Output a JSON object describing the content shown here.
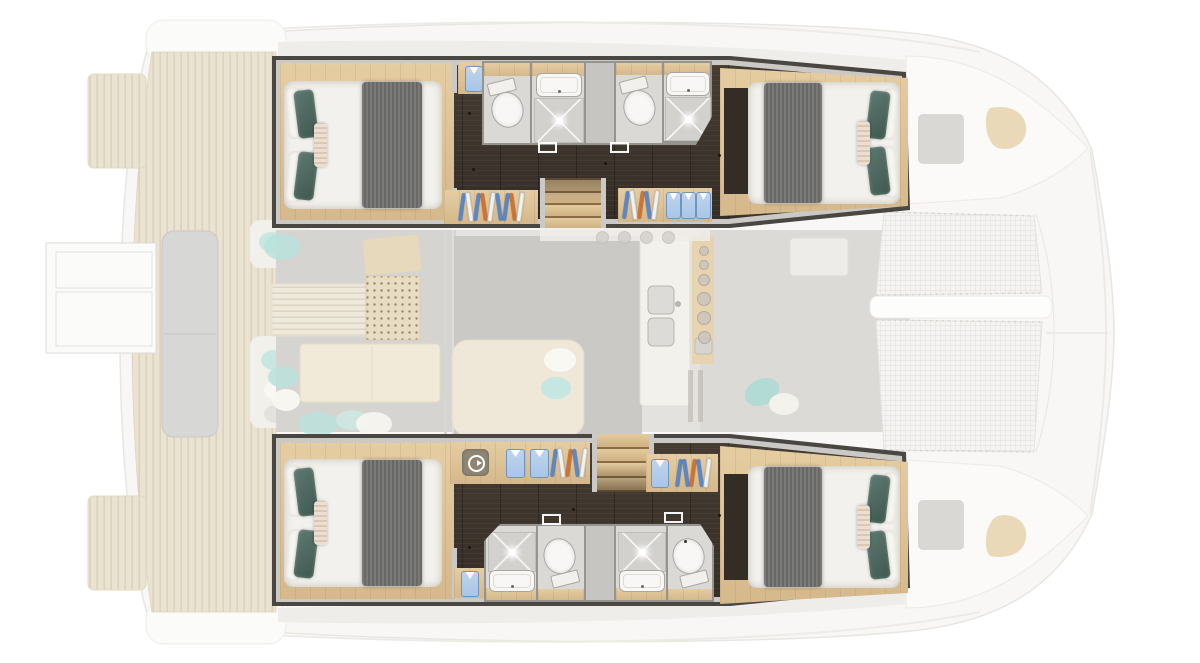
{
  "diagram": {
    "kind": "catamaran-floor-plan",
    "focused_level": "hull accommodation deck (4 cabins, 4 en-suite bathrooms)",
    "faded_level": "main deck (aft cockpit, salon, galley, foredeck trampolines)"
  },
  "colors": {
    "wall_dark": "#4a4742",
    "wall_light": "#cbc9c5",
    "floor_dark": "#342d26",
    "floor_dark_hi": "#473d33",
    "wood": "#d5b88b",
    "wood_hi": "#e5cda2",
    "mattress": "#f3f1ed",
    "pillow_white": "#f7f5f1",
    "teal": "#5d7971",
    "teal_dark": "#40584f",
    "cushion": "#ecdfd2",
    "cushion_line": "#dbc8b4",
    "bath_floor": "#dad9d6",
    "bath_wall": "#96948f",
    "partition": "#c7c5c1",
    "fixture": "#f8f7f5",
    "fixture_line": "#a9a7a2",
    "hanger_blue": "#5b87c5",
    "hanger_orange": "#cc7434",
    "hanger_white": "#f2f1ee",
    "shirt": "#aac6e6",
    "shirt_dark": "#6f94bf",
    "washer_bg": "#8e8574",
    "deck_teak": "#eae3d2",
    "salon_gray": "#cdcbc7",
    "aqua_faded": "#b7e1db",
    "mesh_bg": "#f5f4f2",
    "stove_tan": "#e6d2a8"
  },
  "cabins": [
    {
      "id": "cabin-top-left",
      "bed": "double",
      "head_side": "left",
      "blanket": "gray",
      "pillows": [
        "white",
        "white",
        "teal",
        "teal",
        "striped"
      ]
    },
    {
      "id": "cabin-top-right",
      "bed": "double",
      "head_side": "right",
      "blanket": "gray",
      "pillows": [
        "white",
        "white",
        "teal",
        "teal",
        "striped"
      ]
    },
    {
      "id": "cabin-bottom-left",
      "bed": "double",
      "head_side": "left",
      "blanket": "gray",
      "pillows": [
        "white",
        "white",
        "teal",
        "teal",
        "striped"
      ]
    },
    {
      "id": "cabin-bottom-right",
      "bed": "double",
      "head_side": "right",
      "blanket": "gray",
      "pillows": [
        "white",
        "white",
        "teal",
        "teal",
        "striped"
      ]
    }
  ],
  "bathrooms": [
    {
      "id": "bathroom-top-aft",
      "fixtures": [
        "toilet",
        "sink",
        "shower"
      ]
    },
    {
      "id": "bathroom-top-forward",
      "fixtures": [
        "toilet",
        "sink",
        "shower"
      ]
    },
    {
      "id": "bathroom-bottom-aft",
      "fixtures": [
        "shower",
        "sink",
        "toilet"
      ]
    },
    {
      "id": "bathroom-bottom-forward",
      "fixtures": [
        "shower",
        "sink",
        "toilet"
      ]
    }
  ],
  "hangers": {
    "top_left": [
      "blue",
      "white",
      "blue",
      "orange",
      "white",
      "blue",
      "blue",
      "orange",
      "white"
    ],
    "top_right": [
      "blue",
      "white",
      "orange",
      "blue",
      "white"
    ],
    "bottom_left": [
      "blue",
      "white",
      "orange",
      "blue",
      "white"
    ],
    "bottom_right": [
      "blue",
      "blue",
      "orange",
      "blue",
      "white"
    ]
  },
  "folded_items": {
    "top_left_cabinet": 1,
    "top_right_stack": 3,
    "bottom_strip_shirts": 2,
    "bottom_right_shirts": 1,
    "bottom_cabinet": 1
  },
  "stairs": {
    "top_steps": 4,
    "bottom_steps": 4
  },
  "galley": {
    "burners": 6,
    "stools": 4
  },
  "icons": [
    "washing-machine-icon",
    "hanger-icon",
    "folded-shirt-icon",
    "toilet-icon",
    "sink-icon",
    "shower-icon",
    "stove-burner-icon",
    "galley-sink-icon",
    "trampoline-mesh",
    "deck-hatch",
    "bow-seat",
    "swim-ladder"
  ]
}
